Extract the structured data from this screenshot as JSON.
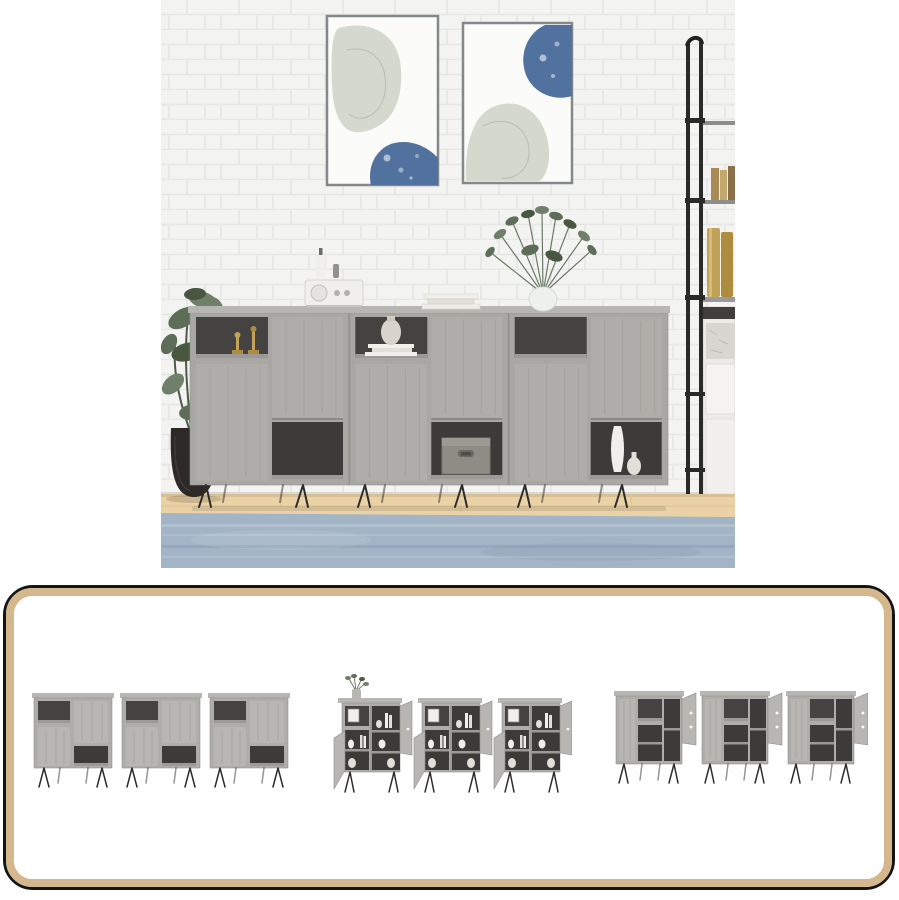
{
  "palette": {
    "page_bg": "#ffffff",
    "panel_border_outer": "#141414",
    "panel_border_inner": "#d4b78d",
    "panel_bg": "#ffffff",
    "wall": "#f3f3f1",
    "brick_line": "#e6e6e4",
    "frame_grey": "#85898b",
    "art_sage": "#d5d8cc",
    "art_blue": "#51719f",
    "cabinet_grey": "#a8a7a3",
    "cabinet_grey_light": "#b7b6b2",
    "cabinet_interior": "#3d3b39",
    "brass_gold": "#c0a259",
    "plant_green": "#5d6d58",
    "pot_dark": "#2d2927",
    "floor_wood": "#ead2a6",
    "rug_blue": "#a2b4c6",
    "leg_metal": "#2e2c2a",
    "ladder_black": "#2a2a28"
  },
  "photo": {
    "name": "sideboard-lifestyle-photo",
    "alt": "Three grey sonoma sideboards against a white brick wall",
    "objects": [
      "brick-wall",
      "wall-art-left",
      "wall-art-right",
      "ladder-shelf",
      "shelf-books",
      "brass-canisters",
      "white-drawer-cabinet",
      "potted-plant",
      "sideboard-unit-1",
      "sideboard-unit-2",
      "sideboard-unit-3",
      "retro-radio",
      "white-bottles",
      "book-stack",
      "vase-with-greenery",
      "gold-candlesticks",
      "round-vase-on-books",
      "storage-basket",
      "white-vases",
      "hairpin-legs",
      "wood-floor",
      "blue-rug"
    ]
  },
  "panel": {
    "name": "product-thumbnail-strip",
    "thumbnails": [
      {
        "name": "thumb-sideboards-closed-front",
        "alt": "3 sideboards closed, front view"
      },
      {
        "name": "thumb-sideboards-open-styled",
        "alt": "3 sideboards with open doors and decor"
      },
      {
        "name": "thumb-sideboards-open-empty",
        "alt": "3 sideboards with open doors, empty, angled view"
      }
    ]
  }
}
